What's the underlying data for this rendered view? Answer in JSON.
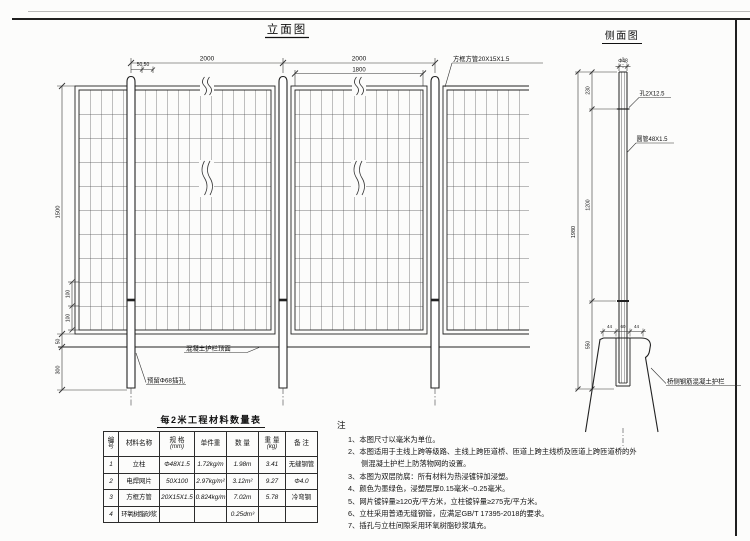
{
  "sheet": {
    "elevation": {
      "title": "立面图",
      "dim_span_left": "2000",
      "dim_span_right": "2000",
      "dim_5050": "50,50",
      "dim_1800": "1800",
      "dim_1500": "1500",
      "dim_100_upper": "100",
      "dim_100_lower": "100",
      "dim_50": "50",
      "dim_300": "300",
      "label_frame_tube": "方框方管20X15X1.5",
      "label_barrier_top": "混凝土护栏顶面",
      "label_socket": "预留Φ68插孔"
    },
    "side": {
      "title": "侧面图",
      "dim_dia": "Φ48",
      "dim_230": "230",
      "dim_1200": "1200",
      "dim_550": "550",
      "dim_1980": "1980",
      "dim_44_left": "44",
      "dim_60": "60",
      "dim_44_right": "44",
      "label_hole": "孔2X12.5",
      "label_tube": "圆管48X1.5",
      "label_barrier": "桥侧钢筋混凝土护栏"
    }
  },
  "table": {
    "title": "每2米工程材料数量表",
    "headers": [
      {
        "l1": "编",
        "l2": "号"
      },
      {
        "l1": "材料名称",
        "l2": ""
      },
      {
        "l1": "规 格",
        "l2": "(mm)"
      },
      {
        "l1": "单件重",
        "l2": ""
      },
      {
        "l1": "数 量",
        "l2": ""
      },
      {
        "l1": "重 量",
        "l2": "(kg)"
      },
      {
        "l1": "备 注",
        "l2": ""
      }
    ],
    "rows": [
      [
        "1",
        "立柱",
        "Φ48X1.5",
        "1.72kg/m",
        "1.98m",
        "3.41",
        "无缝钢管"
      ],
      [
        "2",
        "电焊网片",
        "50X100",
        "2.97kg/m²",
        "3.12m²",
        "9.27",
        "Φ4.0"
      ],
      [
        "3",
        "方框方管",
        "20X15X1.5",
        "0.824kg/m",
        "7.02m",
        "5.78",
        "冷弯钢"
      ],
      [
        "4",
        "环氧树脂砂浆",
        "",
        "",
        "0.25dm³",
        "",
        ""
      ]
    ]
  },
  "notes": {
    "heading": "注",
    "items": [
      "1、本图尺寸以毫米为单位。",
      "2、本图适用于主线上跨等级路、主线上跨匝道桥、匝道上跨主线桥及匝道上跨匝道桥的外侧混凝土护栏上防落物网的设置。",
      "3、本图为双层防腐：所有材料为热浸镀锌加浸塑。",
      "4、颜色为墨绿色，浸塑层厚0.15毫米--0.25毫米。",
      "5、网片镀锌量≥120克/平方米，立柱镀锌量≥275克/平方米。",
      "6、立柱采用普通无缝钢管，应满足GB/T 17395-2018的要求。",
      "7、插孔与立柱间隙采用环氧树脂砂浆填充。"
    ]
  }
}
